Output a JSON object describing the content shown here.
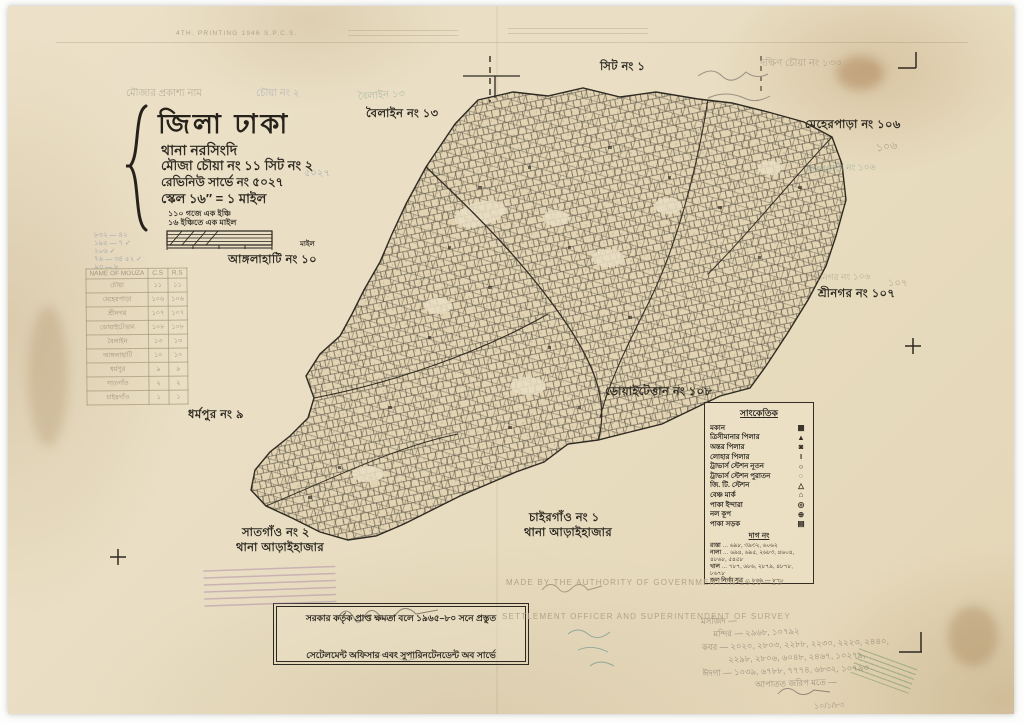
{
  "sheet": {
    "title": "জিলা ঢাকা",
    "thana": "থানা   নরসিংদি",
    "mouza": "মৌজা   চৌয়া নং ১১ সিট নং ২",
    "survey": "রেভিনিউ সার্ভে নং ৫০২৭",
    "scale": "স্কেল ১৬″ = ১ মাইল",
    "scale_note1": "১১০ গজে এক ইঞ্চি",
    "scale_note2": "১৬ ইঞ্চিতে এক মাইল",
    "scale_bar_unit": "মাইল",
    "name_header_note": "মৌজার প্রকাশ্য নাম",
    "name_header_value": "চৌয়া নং ২"
  },
  "adjacent_labels": {
    "sheet1": "সিট নং ১",
    "boilain": "বৈলাইন নং ১৩",
    "meherpara": "মেহেরপাড়া নং ১০৬",
    "srinagar": "শ্রীনগর নং ১০৭",
    "doaitettan": "ডোয়াইটেত্তান নং ১০৮",
    "angulahati": "আঙ্গলাহাটি নং ১০",
    "dharmapur": "ধর্মপুর নং ৯",
    "satgaon_line1": "সাতগাঁও নং ২",
    "satgaon_line2": "থানা আড়াইহাজার",
    "chairgaon_line1": "চাইরগাঁও নং ১",
    "chairgaon_line2": "থানা আড়াইহাজার"
  },
  "legend": {
    "heading": "সাংকেতিক",
    "items": [
      {
        "label": "মকান",
        "symbol": "▦"
      },
      {
        "label": "ত্রিসীমানার পিলার",
        "symbol": "▲"
      },
      {
        "label": "অন্তর পিলার",
        "symbol": "◙"
      },
      {
        "label": "লোহার পিলার",
        "symbol": "I"
      },
      {
        "label": "ট্রাভার্স স্টেশন নূতন",
        "symbol": "○"
      },
      {
        "label": "ট্রাভার্স স্টেশন পুরাতন",
        "symbol": "◌"
      },
      {
        "label": "জি. টি. স্টেশন",
        "symbol": "△"
      },
      {
        "label": "বেঞ্চ মার্ক",
        "symbol": "⌂"
      },
      {
        "label": "পাকা ইন্দারা",
        "symbol": "◎"
      },
      {
        "label": "নল কূপ",
        "symbol": "⊕"
      },
      {
        "label": "পাকা সড়ক",
        "symbol": "▤"
      }
    ],
    "plot_heading": "দাগ নং",
    "plot_rows": [
      {
        "name": "রাস্তা",
        "nums": "৬৯৮, ৩৯৩২, ৬০৬২"
      },
      {
        "name": "নালা",
        "nums": "৬৯৪, ৬৯৫, ২৬৮৩, ৪৬০৪, ৪৮৬৮, ৫৪৫৮"
      },
      {
        "name": "খাল",
        "nums": "৭৮৭, ৬৮৬, ২৮৭৯, ৪৮৭৮, ৮৬৭৮"
      },
      {
        "name": "জল নির্গম সূত্র",
        "nums": "৮৬৯ — ৮৭০"
      }
    ]
  },
  "stamp_box": {
    "line1": "সরকার কর্তৃক প্রাপ্ত ক্ষমতা বলে ১৯৬৫–৮০ সনে প্রস্তুত",
    "line2": "সেটেলমেন্ট অফিসার এবং সুপারিনটেনডেন্ট অব সার্ভে"
  },
  "english_print": {
    "made_by": "MADE BY THE AUTHORITY OF GOVERNMENT IN 1910—13",
    "settlement": "SETTLEMENT OFFICER AND SUPERINTENDENT OF SURVEY",
    "top_left": "4TH. PRINTING 1946   S.P.C.S."
  },
  "mouza_table": {
    "headers": [
      "NAME OF MOUZA",
      "C.S",
      "R.S"
    ],
    "rows": [
      {
        "name": "চৌয়া",
        "c1": "১১",
        "c2": "১১"
      },
      {
        "name": "মেহেরপাড়া",
        "c1": "১০৬",
        "c2": "১০৬"
      },
      {
        "name": "শ্রীনগর",
        "c1": "১০৭",
        "c2": "১০৭"
      },
      {
        "name": "ডোয়াইটেত্তান",
        "c1": "১০৮",
        "c2": "১০৮"
      },
      {
        "name": "বৈলাইন",
        "c1": "১৩",
        "c2": "১৩"
      },
      {
        "name": "আঙ্গলাহাটি",
        "c1": "১০",
        "c2": "১০"
      },
      {
        "name": "ধর্মপুর",
        "c1": "৯",
        "c2": "৯"
      },
      {
        "name": "সাতগাঁও",
        "c1": "২",
        "c2": "২"
      },
      {
        "name": "চাইরগাঁও",
        "c1": "১",
        "c2": "১"
      }
    ]
  },
  "annotations": {
    "top_right_pencil": "দক্ষিণ চৌয়া নং ১৩৩",
    "meherpara_pencil": "মেহেরপাড়া নং ১০৬",
    "srinagar_pencil": "শ্রীনগর নং ১০৬",
    "boilain_pencil": "বৈলাইন ১৩",
    "num_106": "১০৬",
    "num_107": "১০৭",
    "survey_no_pencil": "৫০২৭",
    "blue_notes": [
      "৮৩২ — ৪২",
      "১৯৫ — ৭ ✓",
      "২০৬ ✓",
      "৭৬ — ৩৪  ৫২ ✓",
      "৯৩ — ৮"
    ],
    "pencil_notes": [
      "মসজিদ —",
      "মন্দির — ২৯৬৮, ১০৭৯২",
      "কবর — ২০২০, ২৮০৩, ২২৮৮, ২২৩০, ২২২৩, ২৪৪০,",
      "২২৯৮, ২৮০৬, ৬০৪৮, ২৪৬৭, ১০২৭৯,",
      "ঈদগা — ১০৩৯, ৬৭৮৮, ৭৭৭৪, ৬৮৩২, ১০৭৯৩",
      "আপাতত জরিপ মতে —"
    ],
    "pencil_date": "১০/১/৮৩"
  },
  "colors": {
    "paper": "#e9dec3",
    "ink": "#2e2a22",
    "pencil": "#8d8472",
    "blue_pencil": "#8893ab",
    "faint_print": "#b3a386",
    "purple_stamp": "#a083a8",
    "teal_pencil": "#8fa79a"
  }
}
